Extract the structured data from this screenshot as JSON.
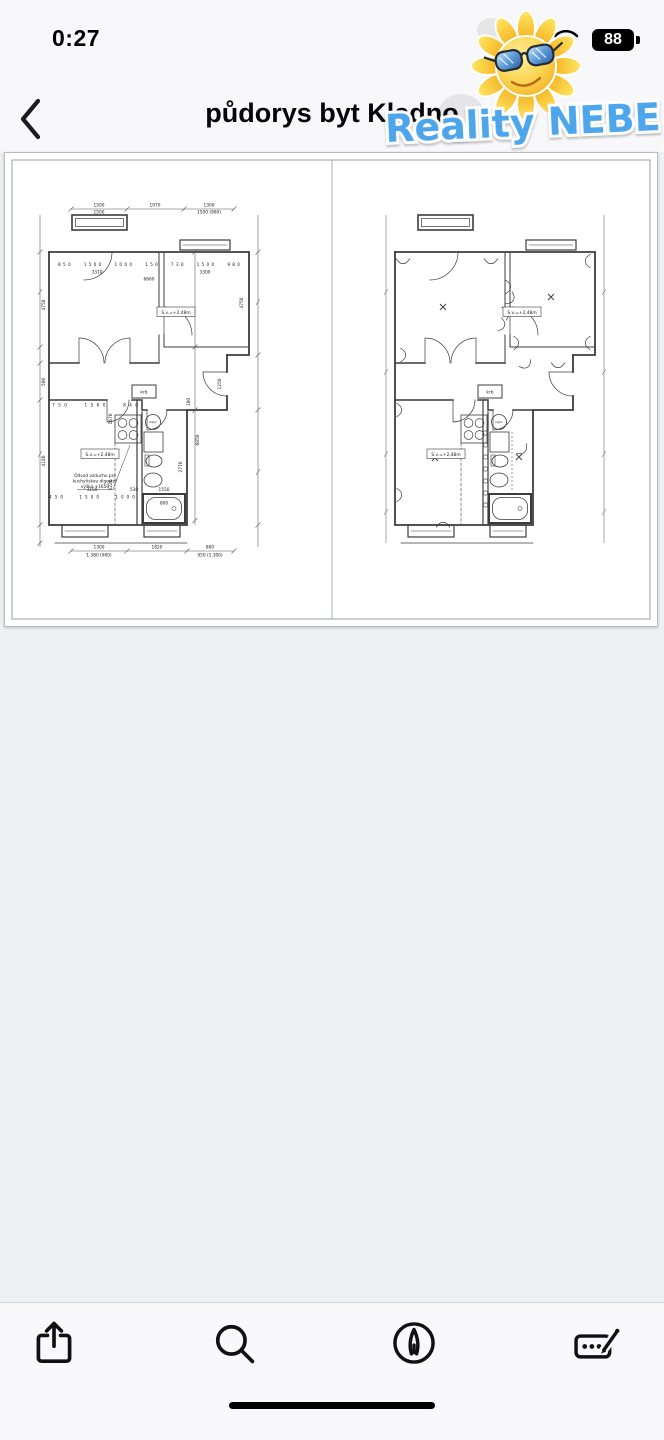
{
  "status_bar": {
    "time": "0:27",
    "battery": "88"
  },
  "header": {
    "title": "půdorys byt Kladno"
  },
  "watermark": {
    "text": "Reality NEBE",
    "logo": "sun-with-sunglasses"
  },
  "icons": {
    "back": "chevron-left-icon",
    "wifi": "wifi-icon",
    "battery": "battery-icon",
    "share": "share-icon",
    "search": "search-icon",
    "navigate": "navigate-icon",
    "markup": "markup-icon",
    "home": "home-indicator"
  },
  "document": {
    "type": "apartment floor plan drawing, two views side by side",
    "plan_left": {
      "dims": {
        "top": [
          "1500",
          "1970",
          "1300"
        ],
        "top2_left": "1500",
        "top2_right": "1500 (960)",
        "wall_row": [
          "850",
          "1500",
          "1000",
          "150",
          "730",
          "1500",
          "980"
        ],
        "width_left": "3310",
        "width_right": "3300",
        "width_total": "6660",
        "height_room": "4750",
        "height_room_right": "4750",
        "corridor": "500",
        "height_total": "6850",
        "kitchen_height": "4180",
        "mid_a": "1670",
        "mid_b": "5220",
        "bath": "2770",
        "hall": "1250",
        "door": "160",
        "lower_row": [
          "750",
          "1560",
          "840"
        ],
        "kitchen_width": "3150",
        "d1": "530",
        "d2": "1550",
        "lower_row2": [
          "450",
          "1500",
          "1000"
        ],
        "tub": "800",
        "out": [
          "1300",
          "1820",
          "800"
        ],
        "out_left": "1.380 (900)",
        "out_right": "950 (1.300)"
      },
      "labels": {
        "ceiling": "S.v.=+2,48m",
        "fireplace": "krb",
        "boiler": "bojler"
      },
      "note": [
        "Odvod vzduchu pro",
        "kuchyňskou digestoř",
        "výška +1650"
      ]
    },
    "plan_right": {
      "labels": {
        "ceiling": "S.v.=+2,48m",
        "fireplace": "krb",
        "boiler": "bojler"
      }
    }
  }
}
